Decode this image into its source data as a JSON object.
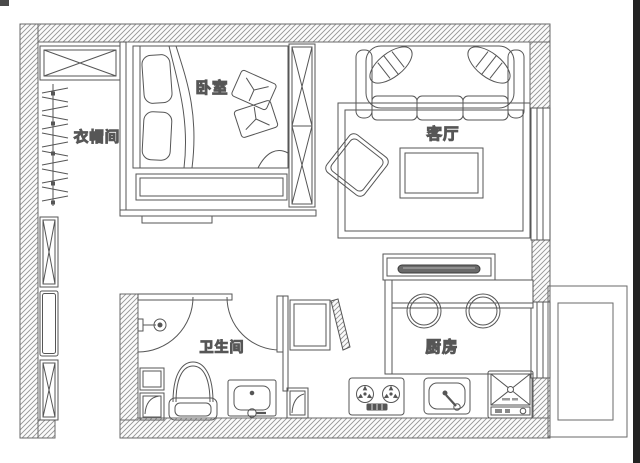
{
  "page": {
    "type": "apartment floor plan",
    "background": "#ffffff",
    "photo_edge_color": "#222222"
  },
  "rooms": {
    "bedroom": {
      "label": "卧室"
    },
    "cloakroom": {
      "label": "衣帽间"
    },
    "living_room": {
      "label": "客厅"
    },
    "bathroom": {
      "label": "卫生间"
    },
    "kitchen": {
      "label": "厨房"
    }
  },
  "colors": {
    "line": "#565656",
    "wall_hatch_line": "#949494",
    "label_text": "#141414",
    "tray_fill": "#6a6a6a"
  }
}
